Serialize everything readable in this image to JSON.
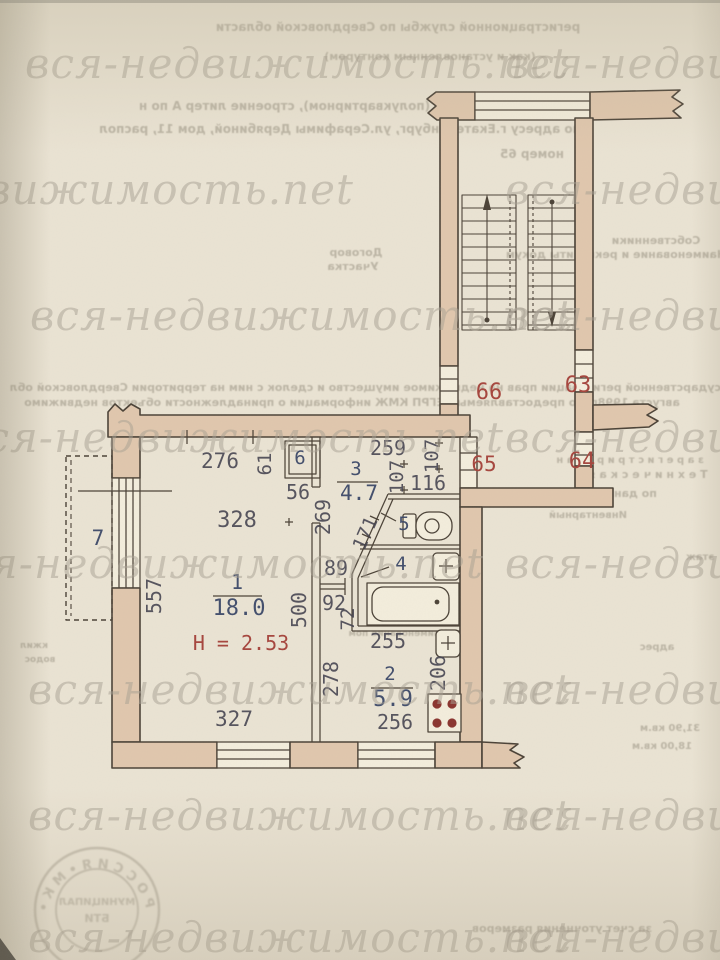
{
  "colors": {
    "paper": "#eae3d3",
    "paper2": "#f3eddc",
    "wall": "#e0c7ad",
    "line": "#4b4237",
    "dim": "#41404d",
    "blue": "#3a4767",
    "red": "#a6453d",
    "wm": "#a8a093",
    "show": "#8f8878",
    "stamp": "#8d8574",
    "burner": "#8a342e"
  },
  "plan": {
    "type": "apartment floor plan",
    "ceiling_height_note": "H = 2.53",
    "rooms": [
      {
        "id": "room-1",
        "number": "1",
        "area": "18.0"
      },
      {
        "id": "room-2",
        "number": "2",
        "area": "5.9"
      },
      {
        "id": "room-3",
        "number": "3",
        "area": "4.7"
      },
      {
        "id": "room-4",
        "number": "4",
        "area": ""
      },
      {
        "id": "room-5",
        "number": "5",
        "area": ""
      },
      {
        "id": "closet-6",
        "number": "6",
        "area": ""
      },
      {
        "id": "balcony-7",
        "number": "7",
        "area": ""
      }
    ],
    "apartment_numbers_on_landing": [
      "66",
      "63",
      "65",
      "64"
    ]
  },
  "labels": [
    {
      "name": "dim-276",
      "text": "276",
      "x": 220,
      "y": 468,
      "cls": "dim",
      "size": 21
    },
    {
      "name": "dim-61",
      "text": "61",
      "x": 271,
      "y": 464,
      "rot": -90,
      "cls": "dim",
      "size": 19
    },
    {
      "name": "dim-56",
      "text": "56",
      "x": 298,
      "y": 499,
      "cls": "dim",
      "size": 20
    },
    {
      "name": "dim-259",
      "text": "259",
      "x": 388,
      "y": 455,
      "cls": "dim",
      "size": 20
    },
    {
      "name": "dim-107-a",
      "text": "107",
      "x": 403,
      "y": 477,
      "rot": -90,
      "cls": "dim",
      "size": 19
    },
    {
      "name": "dim-107-b",
      "text": "107",
      "x": 438,
      "y": 456,
      "rot": -90,
      "cls": "dim",
      "size": 19
    },
    {
      "name": "dim-116",
      "text": "116",
      "x": 428,
      "y": 490,
      "cls": "dim",
      "size": 20
    },
    {
      "name": "dim-269",
      "text": "269",
      "x": 330,
      "y": 517,
      "rot": -90,
      "cls": "dim",
      "size": 20
    },
    {
      "name": "dim-171",
      "text": "171",
      "x": 371,
      "y": 536,
      "rot": -66,
      "cls": "dim",
      "size": 19
    },
    {
      "name": "dim-89",
      "text": "89",
      "x": 336,
      "y": 575,
      "cls": "dim",
      "size": 20
    },
    {
      "name": "dim-92",
      "text": "92",
      "x": 334,
      "y": 610,
      "cls": "dim",
      "size": 20
    },
    {
      "name": "dim-72",
      "text": "72",
      "x": 354,
      "y": 619,
      "rot": -90,
      "cls": "dim",
      "size": 19
    },
    {
      "name": "dim-500",
      "text": "500",
      "x": 306,
      "y": 610,
      "rot": -90,
      "cls": "dim",
      "size": 20
    },
    {
      "name": "dim-557",
      "text": "557",
      "x": 161,
      "y": 596,
      "rot": -90,
      "cls": "dim",
      "size": 20
    },
    {
      "name": "dim-328",
      "text": "328",
      "x": 237,
      "y": 527,
      "cls": "dim",
      "size": 22
    },
    {
      "name": "dim-327",
      "text": "327",
      "x": 234,
      "y": 726,
      "cls": "dim",
      "size": 21
    },
    {
      "name": "dim-255",
      "text": "255",
      "x": 388,
      "y": 648,
      "cls": "dim",
      "size": 20
    },
    {
      "name": "dim-256",
      "text": "256",
      "x": 395,
      "y": 729,
      "cls": "dim",
      "size": 20
    },
    {
      "name": "dim-278",
      "text": "278",
      "x": 338,
      "y": 679,
      "rot": -90,
      "cls": "dim",
      "size": 20
    },
    {
      "name": "dim-206",
      "text": "206",
      "x": 445,
      "y": 673,
      "rot": -90,
      "cls": "dim",
      "size": 20
    },
    {
      "name": "room-1-number",
      "text": "1",
      "x": 237,
      "y": 589,
      "cls": "room",
      "size": 20
    },
    {
      "name": "room-1-area",
      "text": "18.0",
      "x": 239,
      "y": 615,
      "cls": "room",
      "size": 22
    },
    {
      "name": "room-2-number",
      "text": "2",
      "x": 390,
      "y": 680,
      "cls": "room",
      "size": 19
    },
    {
      "name": "room-2-area",
      "text": "5.9",
      "x": 393,
      "y": 706,
      "cls": "room",
      "size": 22
    },
    {
      "name": "room-3-number",
      "text": "3",
      "x": 356,
      "y": 475,
      "cls": "room",
      "size": 19
    },
    {
      "name": "room-3-area",
      "text": "4.7",
      "x": 359,
      "y": 500,
      "cls": "room",
      "size": 21
    },
    {
      "name": "room-4-number",
      "text": "4",
      "x": 401,
      "y": 570,
      "cls": "room",
      "size": 19
    },
    {
      "name": "room-5-number",
      "text": "5",
      "x": 404,
      "y": 530,
      "cls": "room",
      "size": 19
    },
    {
      "name": "closet-6-number",
      "text": "6",
      "x": 300,
      "y": 464,
      "cls": "room",
      "size": 19
    },
    {
      "name": "balcony-7-number",
      "text": "7",
      "x": 98,
      "y": 545,
      "cls": "room",
      "size": 21
    },
    {
      "name": "apt-66",
      "text": "66",
      "x": 489,
      "y": 399,
      "cls": "red",
      "size": 22
    },
    {
      "name": "apt-63",
      "text": "63",
      "x": 578,
      "y": 392,
      "cls": "red",
      "size": 22
    },
    {
      "name": "apt-65",
      "text": "65",
      "x": 484,
      "y": 471,
      "cls": "red",
      "size": 21
    },
    {
      "name": "apt-64",
      "text": "64",
      "x": 582,
      "y": 468,
      "cls": "red",
      "size": 22
    },
    {
      "name": "ceiling-height",
      "text": "H = 2.53",
      "x": 241,
      "y": 650,
      "cls": "red",
      "size": 20
    }
  ],
  "watermark": {
    "text": "вся-недвижимость.net",
    "size": 42,
    "rows": [
      {
        "y": 78,
        "xs": [
          25,
          505
        ]
      },
      {
        "y": 204,
        "xs": [
          -190,
          505
        ]
      },
      {
        "y": 330,
        "xs": [
          30,
          505
        ]
      },
      {
        "y": 452,
        "xs": [
          -40,
          505
        ]
      },
      {
        "y": 578,
        "xs": [
          -60,
          505
        ]
      },
      {
        "y": 704,
        "xs": [
          28,
          505
        ]
      },
      {
        "y": 830,
        "xs": [
          28,
          505
        ]
      },
      {
        "y": 952,
        "xs": [
          28,
          505
        ]
      }
    ]
  },
  "showthrough": [
    {
      "text": "регистрационной службы по Свердловской области",
      "x": 398,
      "y": 31,
      "size": 12
    },
    {
      "text": "(как и установленным контуром)",
      "x": 430,
      "y": 60,
      "size": 11
    },
    {
      "text": "что в жилом доме (полуквартирном), строение литер А по н",
      "x": 350,
      "y": 110,
      "size": 12
    },
    {
      "text": "по адресу г.Екатеринбург, ул.Серафимы Дерябиной, дом 11, распол",
      "x": 340,
      "y": 133,
      "size": 12
    },
    {
      "text": "номер 65",
      "x": 532,
      "y": 158,
      "size": 12
    },
    {
      "text": "Собственники",
      "x": 656,
      "y": 244,
      "size": 11
    },
    {
      "text": "Договор",
      "x": 356,
      "y": 256,
      "size": 11
    },
    {
      "text": "Участка",
      "x": 353,
      "y": 270,
      "size": 11
    },
    {
      "text": "Наименование и реквизиты докум",
      "x": 616,
      "y": 258,
      "size": 11
    },
    {
      "text": "государственной регистрации прав на недвижимое имущество и сделок с ним на территории Свердловской обл",
      "x": 372,
      "y": 391,
      "size": 11
    },
    {
      "text": "августа 1998г. по предоставляемым ЕГРП КМЖ информации о принадлежности объектов недвижимо",
      "x": 352,
      "y": 406,
      "size": 11
    },
    {
      "text": "з а р е г и с т р и р о в а н",
      "x": 630,
      "y": 463,
      "size": 10
    },
    {
      "text": "Т е х н и ч е с к а я",
      "x": 648,
      "y": 478,
      "size": 11
    },
    {
      "text": "по данным обследования",
      "x": 575,
      "y": 497,
      "size": 11
    },
    {
      "text": "Инвентарный",
      "x": 588,
      "y": 518,
      "size": 10
    },
    {
      "text": "этаж",
      "x": 700,
      "y": 560,
      "size": 10
    },
    {
      "text": "Наименование пом",
      "x": 398,
      "y": 636,
      "size": 9
    },
    {
      "text": "адрес",
      "x": 657,
      "y": 650,
      "size": 10
    },
    {
      "text": "31,90 кв.м",
      "x": 670,
      "y": 731,
      "size": 10
    },
    {
      "text": "18,00 кв.м",
      "x": 662,
      "y": 749,
      "size": 10
    },
    {
      "text": "за счет уточнения размеров",
      "x": 562,
      "y": 932,
      "size": 11
    },
    {
      "text": "водос",
      "x": 40,
      "y": 662,
      "size": 9
    },
    {
      "text": "кжил",
      "x": 34,
      "y": 648,
      "size": 9
    }
  ],
  "stamp": {
    "ring_text": "Р О С С И Я  •  М К  •",
    "inner_line_1": "МУНИЦИПАЛ",
    "inner_line_2": "БТИ"
  }
}
